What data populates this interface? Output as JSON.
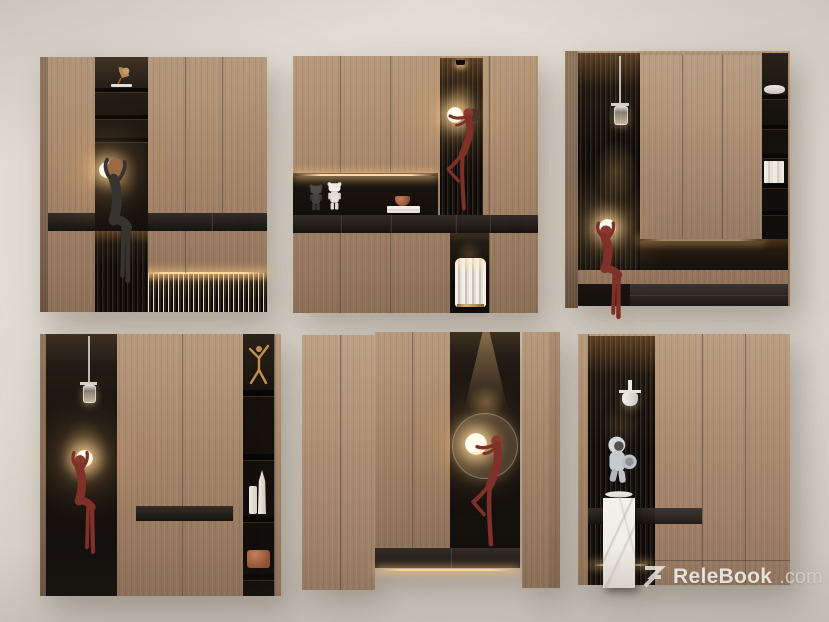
{
  "watermark": {
    "logo": "relebook-logo",
    "brand": "ReleBook",
    "suffix": ".com"
  },
  "palette": {
    "wall_hi": "#ebe7de",
    "wall_mid": "#ded9d0",
    "wall_lo": "#c7c3bc",
    "wood": "#a8876a",
    "wood_hi": "#b79a7c",
    "wood_lo": "#8d7058",
    "wood_side": "#7c6350",
    "niche_top": "#3d2f21",
    "niche_dark": "#130f0c",
    "band": "#27221d",
    "bench": "#14100d",
    "led": "#ffd9a0",
    "glow_core": "#fffdf2",
    "red_figure": "#7e3029",
    "dark_figure": "#37332f",
    "copper": "#a06b44",
    "gold": "#c3914f",
    "white_obj": "#edeae4",
    "silver": "#cdcfd2",
    "marble": "#f0ede8",
    "watermark_text": "#f3f0ea",
    "watermark_dim": "#d8d3cb"
  },
  "cabinets": [
    {
      "id": "cabinet-top-left",
      "decor": [
        "gramophone-ornament",
        "seated-figure-sphere-lamp",
        "ribbed-base-lighting"
      ]
    },
    {
      "id": "cabinet-top-middle",
      "decor": [
        "bearbrick-toy-dark",
        "bearbrick-toy-white",
        "book-stack",
        "copper-bowl",
        "downlight",
        "dancer-figure-sphere-lamp",
        "fluted-stool"
      ]
    },
    {
      "id": "cabinet-top-right",
      "decor": [
        "pendant-lamp",
        "seated-figure-sphere-lamp",
        "plate-stack",
        "book-stack"
      ]
    },
    {
      "id": "cabinet-bottom-left",
      "decor": [
        "pendant-lamp",
        "seated-figure-sphere-lamp",
        "gymnast-ornament",
        "candle-and-vase",
        "copper-box"
      ]
    },
    {
      "id": "cabinet-bottom-middle",
      "decor": [
        "spotlight",
        "halo-sphere-lamp",
        "dancer-figure"
      ]
    },
    {
      "id": "cabinet-bottom-right",
      "decor": [
        "wall-sconce",
        "astronaut-figurine",
        "marble-pedestal"
      ]
    }
  ]
}
